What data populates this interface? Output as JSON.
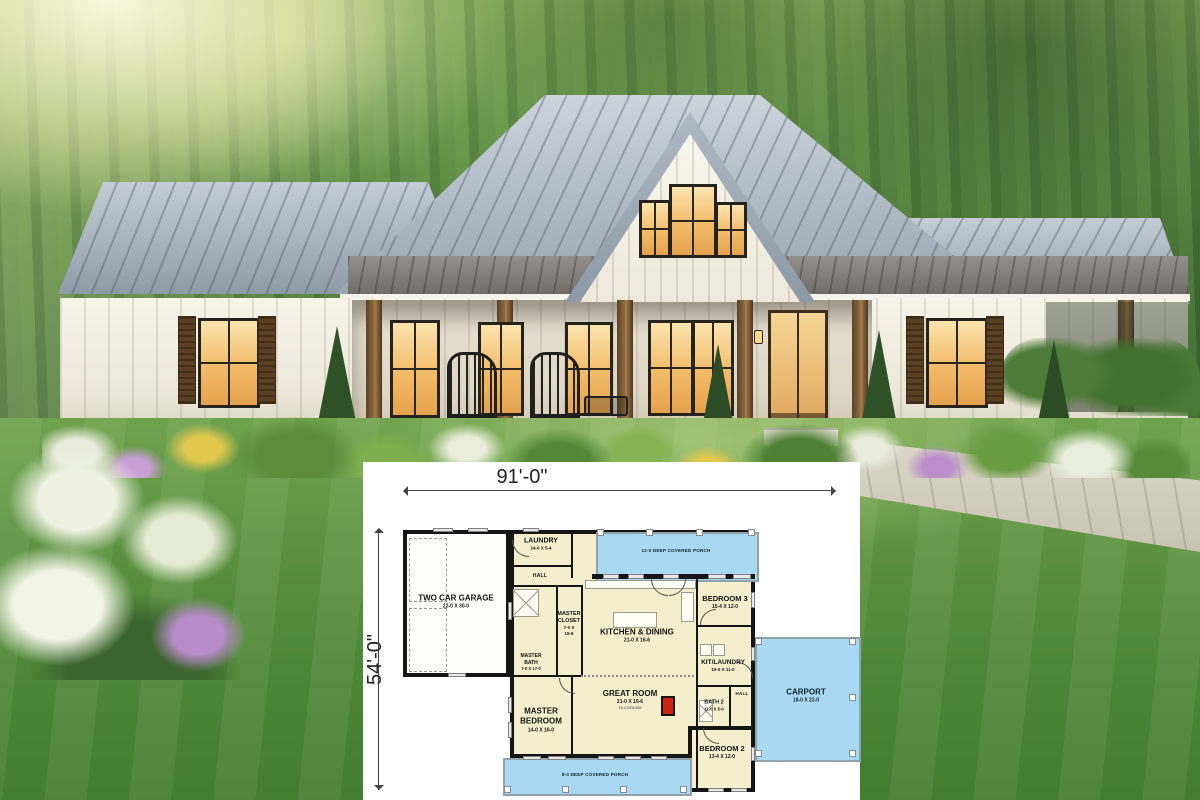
{
  "photo": {
    "colors": {
      "roof_metal": "#9aa6b2",
      "porch_roof": "#77746f",
      "siding_white": "#f5f1e6",
      "wood_post": "#8a6840",
      "window_glow": "#f2bb68",
      "lawn_green": "#5d9342",
      "forest_green": "#568540",
      "hydrangea_white": "#eff2e2",
      "flower_purple": "#b78cc9",
      "flower_yellow": "#e3c84e"
    }
  },
  "floor_plan": {
    "overall_width": "91'-0\"",
    "overall_depth": "54'-0\"",
    "rooms": {
      "garage": {
        "name": "TWO CAR GARAGE",
        "dims": "22-0 X 30-0"
      },
      "laundry": {
        "name": "LAUNDRY",
        "dims": "14-0 X 5-4"
      },
      "hall_top": {
        "name": "HALL"
      },
      "master_closet": {
        "name": "MASTER CLOSET",
        "dims": "7-0 X 15-6"
      },
      "master_bath": {
        "name": "MASTER BATH",
        "dims": "7-0 X 17-0"
      },
      "kitchen": {
        "name": "KITCHEN & DINING",
        "dims": "21-0 X 16-6"
      },
      "bedroom3": {
        "name": "BEDROOM 3",
        "dims": "15-4 X 12-0"
      },
      "kit_laundry": {
        "name": "KIT/LAUNDRY",
        "dims": "15-0 X 11-0"
      },
      "hall_right": {
        "name": "HALL"
      },
      "bath2": {
        "name": "BATH 2",
        "dims": "11-0 X 5-0"
      },
      "great_room": {
        "name": "GREAT ROOM",
        "dims": "21-0 X 19-6",
        "note": "10-4 CEILING"
      },
      "master_bedroom": {
        "name": "MASTER BEDROOM",
        "dims": "14-0 X 16-0"
      },
      "bedroom2": {
        "name": "BEDROOM 2",
        "dims": "13-4 X 12-0"
      },
      "carport": {
        "name": "CARPORT",
        "dims": "18-0 X 22-0"
      },
      "porch_top": {
        "name": "12-0 DEEP COVERED PORCH"
      },
      "porch_bottom": {
        "name": "8-0 DEEP COVERED PORCH"
      }
    },
    "colors": {
      "room_fill": "#f5eecd",
      "porch_fill": "#a9d9f2",
      "wall": "#151515",
      "fireplace_red": "#cc2211"
    }
  }
}
